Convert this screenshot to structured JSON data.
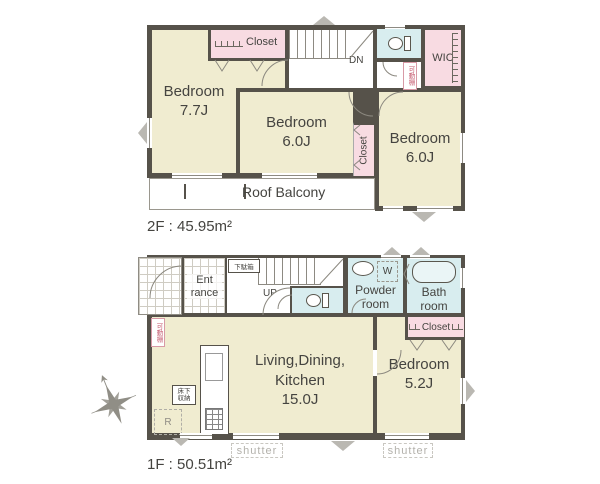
{
  "colors": {
    "wall": "#56524a",
    "room_cream": "#f0ecd0",
    "closet_pink": "#f8dbe2",
    "wet_blue": "#d8edef",
    "balcony_border": "#9a978e",
    "label_text": "#454440",
    "muted_text": "#b3b1ab"
  },
  "f2": {
    "area_label": "2F : 45.95m²",
    "bedroom1": {
      "name": "Bedroom",
      "size": "7.7J"
    },
    "bedroom2": {
      "name": "Bedroom",
      "size": "6.0J"
    },
    "bedroom3": {
      "name": "Bedroom",
      "size": "6.0J"
    },
    "closet_top": "Closet",
    "closet_side": "Closet",
    "wic": "WIC",
    "stairs": "DN",
    "shelf": "可動棚",
    "balcony": "Roof Balcony"
  },
  "f1": {
    "area_label": "1F : 50.51m²",
    "entrance": {
      "line1": "Ent",
      "line2": "rance"
    },
    "shoe_cabinet": "下駄箱",
    "stairs": "UP",
    "powder": {
      "line1": "Powder",
      "line2": "room"
    },
    "washer": "W",
    "bath": {
      "line1": "Bath",
      "line2": "room"
    },
    "closet": "Closet",
    "shelf": "可動棚",
    "ldk": {
      "line1": "Living,Dining,",
      "line2": "Kitchen",
      "size": "15.0J"
    },
    "floor_storage": {
      "line1": "床下",
      "line2": "収納"
    },
    "fridge": "R",
    "bedroom": {
      "name": "Bedroom",
      "size": "5.2J"
    },
    "shutter_left": "shutter",
    "shutter_right": "shutter"
  }
}
